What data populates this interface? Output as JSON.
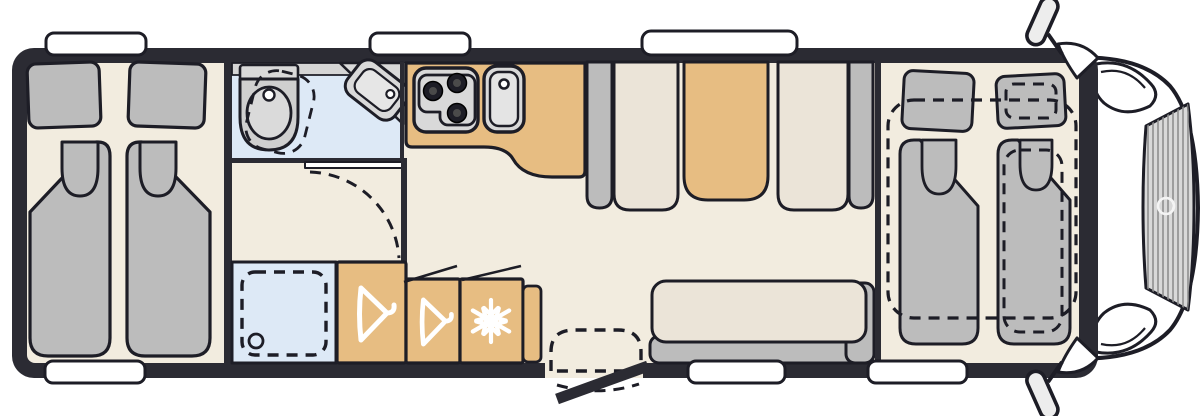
{
  "page": {
    "title": "Motorhome floor plan — top view"
  },
  "colors": {
    "wall": "#2b2b33",
    "outline": "#1d1d26",
    "floor": "#f2ecdf",
    "seat": "#ebe4d8",
    "cushion": "#bcbcbc",
    "tan": "#e7bd82",
    "bath": "#dde9f6",
    "appliance": "#d9d9d9",
    "step": "#eae8e0",
    "band": "#d5d5d5",
    "white": "#ffffff"
  },
  "floorplan": {
    "vehicle": {
      "type": "motorhome",
      "view": "top-down",
      "orientation": "cab-right"
    },
    "regions": {
      "rear_bedroom": {
        "label": "Rear bedroom with twin single beds and pillows"
      },
      "bathroom": {
        "label": "Washroom with swivel toilet and corner basin"
      },
      "dressing_room": {
        "label": "Changing area with hinged door"
      },
      "shower": {
        "label": "Shower cubicle with drain"
      },
      "wardrobe_large": {
        "label": "Wardrobe with clothes hanger"
      },
      "wardrobe_small": {
        "label": "Small wardrobe with clothes hanger"
      },
      "fridge": {
        "label": "Refrigerator"
      },
      "kitchen": {
        "label": "Kitchen block with 3-burner hob and sink"
      },
      "dinette": {
        "label": "Face-to-face dinette with table"
      },
      "sofa": {
        "label": "Side bench sofa"
      },
      "front_beds": {
        "label": "Drop-down front beds over cab (shown dashed)"
      },
      "cab": {
        "label": "Driver cab with windshield, mirrors and headlights"
      },
      "entry_door": {
        "label": "Entry door with step, shown open"
      }
    },
    "fixtures": {
      "stove": {
        "label": "3-burner gas hob",
        "burners": 3
      },
      "kitchen_sink": {
        "label": "Kitchen sink with faucet"
      },
      "toilet": {
        "label": "Swivel cassette toilet"
      },
      "corner_basin": {
        "label": "Corner washbasin"
      },
      "shower_tray": {
        "label": "Shower tray (dashed) with drain"
      },
      "table": {
        "label": "Dinette table"
      }
    },
    "icons": {
      "hanger": "clothes-hanger-icon",
      "snowflake": "snowflake-icon",
      "brand_swirl": "brand-logo-swirl"
    },
    "windows": {
      "top": 3,
      "bottom": 3
    }
  }
}
